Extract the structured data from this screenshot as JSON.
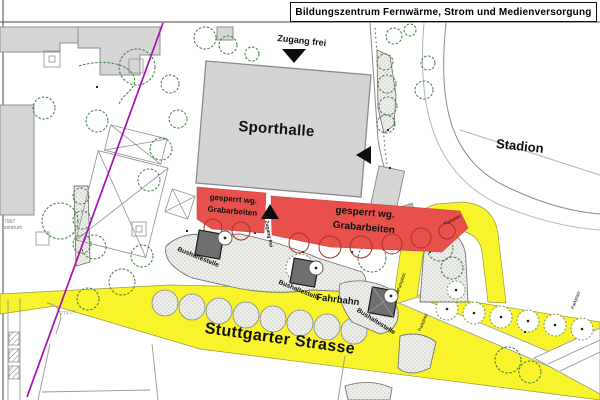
{
  "title": "Bildungszentrum Fernwärme, Strom und Medienversorgung",
  "labels": {
    "sporthalle": "Sporthalle",
    "stadion": "Stadion",
    "zugang_frei": "Zugang frei",
    "zugang_frei_small": "Zugang frei",
    "fahrbahn": "Fahrbahn",
    "strasse": "Stuttgarter Strasse",
    "closed_line1": "gesperrt wg.",
    "closed_line2": "Grabarbeiten",
    "bushaltestelle": "Bushaltestelle",
    "parkplatz": "Parkplatz",
    "parcel_7067": "7067",
    "parcel_zentrum": "zentrum",
    "parcel_7747": "7747/7"
  },
  "colors": {
    "road-yellow": "#f8f32b",
    "closed-red": "#e8514b",
    "building-gray": "#d6d6d6",
    "shelter-gray": "#6f6f6f",
    "boundary-magenta": "#a810ad",
    "tree-green": "#3d7d3c"
  }
}
